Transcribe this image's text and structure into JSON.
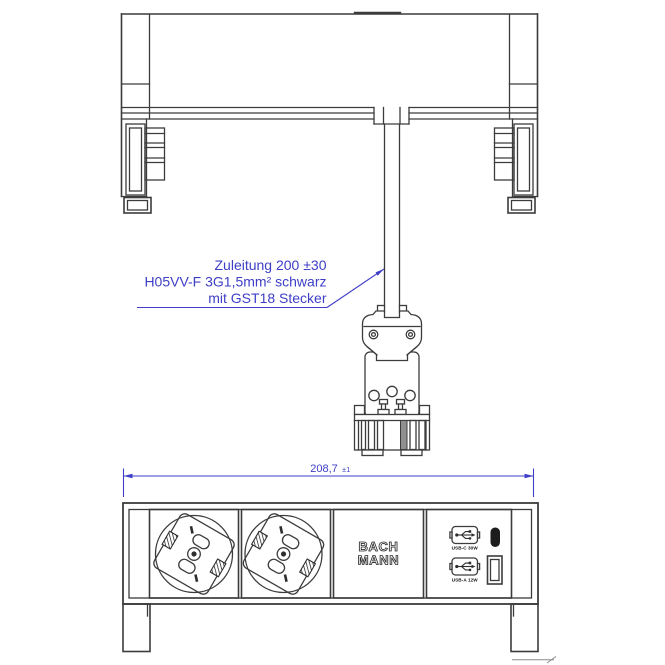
{
  "front_view": {
    "annotation": {
      "line1": "Zuleitung 200 ±30",
      "line2": "H05VV-F 3G1,5mm² schwarz",
      "line3": "mit GST18 Stecker"
    }
  },
  "top_view": {
    "dimension": {
      "value": "208,7",
      "tolerance": "±1"
    },
    "logo": {
      "line1": "BACH",
      "line2": "MANN"
    },
    "usb_module": {
      "usb_c_label": "USB-C 30W",
      "usb_a_label": "USB-A 12W"
    }
  },
  "colors": {
    "line": "#3c3c3c",
    "annotation_blue": "#3e3ec6",
    "port_black": "#1c1c1c"
  }
}
